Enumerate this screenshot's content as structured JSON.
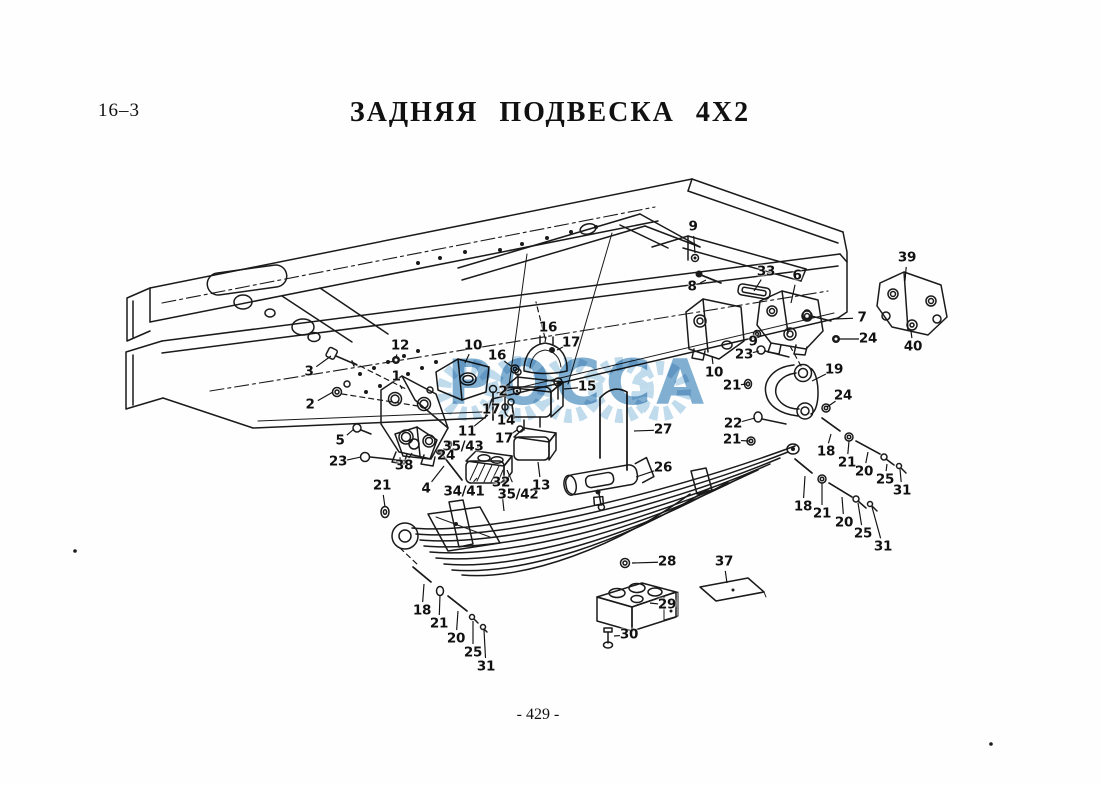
{
  "page": {
    "section_number": "16–3",
    "title": "ЗАДНЯЯ ПОДВЕСКА 4X2",
    "page_number": "- 429 -",
    "watermark_text": "РОССА",
    "watermark_color": "#5d9ac6",
    "ink_color": "#1a1a1a"
  },
  "diagram": {
    "description": "Exploded isometric parts view: truck ladder frame, spring brackets, shackle, multi-leaf spring, U-bolt, rubber buffers and fasteners",
    "callouts": [
      {
        "label": "9",
        "x": 693,
        "y": 227,
        "tx": 695,
        "ty": 253
      },
      {
        "label": "8",
        "x": 692,
        "y": 287,
        "tx": 706,
        "ty": 280
      },
      {
        "label": "33",
        "x": 766,
        "y": 272,
        "tx": 754,
        "ty": 291
      },
      {
        "label": "6",
        "x": 797,
        "y": 276,
        "tx": 791,
        "ty": 303
      },
      {
        "label": "7",
        "x": 862,
        "y": 318,
        "tx": 833,
        "ty": 319
      },
      {
        "label": "24",
        "x": 868,
        "y": 339,
        "tx": 838,
        "ty": 339
      },
      {
        "label": "39",
        "x": 907,
        "y": 258,
        "tx": 905,
        "ty": 281
      },
      {
        "label": "40",
        "x": 913,
        "y": 347,
        "tx": 911,
        "ty": 331
      },
      {
        "label": "9",
        "x": 753,
        "y": 342,
        "tx": 758,
        "ty": 337
      },
      {
        "label": "23",
        "x": 744,
        "y": 355,
        "tx": 759,
        "ty": 351
      },
      {
        "label": "10",
        "x": 714,
        "y": 373,
        "tx": 712,
        "ty": 356
      },
      {
        "label": "21",
        "x": 732,
        "y": 386,
        "tx": 746,
        "ty": 384
      },
      {
        "label": "19",
        "x": 834,
        "y": 370,
        "tx": 812,
        "ty": 381
      },
      {
        "label": "24",
        "x": 843,
        "y": 396,
        "tx": 827,
        "ty": 407
      },
      {
        "label": "22",
        "x": 733,
        "y": 424,
        "tx": 755,
        "ty": 418
      },
      {
        "label": "21",
        "x": 732,
        "y": 440,
        "tx": 749,
        "ty": 441
      },
      {
        "label": "18",
        "x": 826,
        "y": 452,
        "tx": 831,
        "ty": 434
      },
      {
        "label": "21",
        "x": 847,
        "y": 463,
        "tx": 849,
        "ty": 441
      },
      {
        "label": "20",
        "x": 864,
        "y": 472,
        "tx": 868,
        "ty": 452
      },
      {
        "label": "25",
        "x": 885,
        "y": 480,
        "tx": 887,
        "ty": 464
      },
      {
        "label": "31",
        "x": 902,
        "y": 491,
        "tx": 900,
        "ty": 469
      },
      {
        "label": "18",
        "x": 803,
        "y": 507,
        "tx": 805,
        "ty": 476
      },
      {
        "label": "21",
        "x": 822,
        "y": 514,
        "tx": 822,
        "ty": 483
      },
      {
        "label": "20",
        "x": 844,
        "y": 523,
        "tx": 842,
        "ty": 497
      },
      {
        "label": "25",
        "x": 863,
        "y": 534,
        "tx": 858,
        "ty": 503
      },
      {
        "label": "31",
        "x": 883,
        "y": 547,
        "tx": 872,
        "ty": 507
      },
      {
        "label": "3",
        "x": 309,
        "y": 372,
        "tx": 331,
        "ty": 356
      },
      {
        "label": "12",
        "x": 400,
        "y": 346,
        "tx": 396,
        "ty": 357
      },
      {
        "label": "10",
        "x": 473,
        "y": 346,
        "tx": 465,
        "ty": 363
      },
      {
        "label": "1",
        "x": 396,
        "y": 377,
        "tx": 402,
        "ty": 389
      },
      {
        "label": "2",
        "x": 310,
        "y": 405,
        "tx": 333,
        "ty": 392
      },
      {
        "label": "5",
        "x": 340,
        "y": 441,
        "tx": 354,
        "ty": 429
      },
      {
        "label": "23",
        "x": 338,
        "y": 462,
        "tx": 361,
        "ty": 457
      },
      {
        "label": "38",
        "x": 404,
        "y": 466,
        "tx": 412,
        "ty": 453
      },
      {
        "label": "21",
        "x": 382,
        "y": 486,
        "tx": 385,
        "ty": 507
      },
      {
        "label": "4",
        "x": 426,
        "y": 489,
        "tx": 444,
        "ty": 466
      },
      {
        "label": "16",
        "x": 548,
        "y": 328,
        "tx": 545,
        "ty": 342
      },
      {
        "label": "17",
        "x": 571,
        "y": 343,
        "tx": 557,
        "ty": 350
      },
      {
        "label": "16",
        "x": 497,
        "y": 356,
        "tx": 511,
        "ty": 366
      },
      {
        "label": "2",
        "x": 503,
        "y": 392,
        "tx": 513,
        "ty": 391
      },
      {
        "label": "15",
        "x": 587,
        "y": 387,
        "tx": 564,
        "ty": 389
      },
      {
        "label": "17",
        "x": 491,
        "y": 410,
        "tx": 501,
        "ty": 407
      },
      {
        "label": "14",
        "x": 506,
        "y": 421,
        "tx": 511,
        "ty": 413
      },
      {
        "label": "11",
        "x": 467,
        "y": 432,
        "tx": 488,
        "ty": 415
      },
      {
        "label": "17",
        "x": 504,
        "y": 439,
        "tx": 517,
        "ty": 430
      },
      {
        "label": "35/43",
        "x": 463,
        "y": 447,
        "tx": 479,
        "ty": 447
      },
      {
        "label": "24",
        "x": 446,
        "y": 456,
        "tx": 449,
        "ty": 448
      },
      {
        "label": "34/41",
        "x": 464,
        "y": 492,
        "tx": 477,
        "ty": 478
      },
      {
        "label": "32",
        "x": 501,
        "y": 483,
        "tx": 504,
        "ty": 511
      },
      {
        "label": "35/42",
        "x": 518,
        "y": 495,
        "tx": 507,
        "ty": 470
      },
      {
        "label": "13",
        "x": 541,
        "y": 486,
        "tx": 538,
        "ty": 462
      },
      {
        "label": "27",
        "x": 663,
        "y": 430,
        "tx": 634,
        "ty": 431
      },
      {
        "label": "26",
        "x": 663,
        "y": 468,
        "tx": 636,
        "ty": 477
      },
      {
        "label": "28",
        "x": 667,
        "y": 562,
        "tx": 632,
        "ty": 563
      },
      {
        "label": "29",
        "x": 667,
        "y": 605,
        "tx": 650,
        "ty": 603
      },
      {
        "label": "30",
        "x": 629,
        "y": 635,
        "tx": 614,
        "ty": 636
      },
      {
        "label": "37",
        "x": 724,
        "y": 562,
        "tx": 727,
        "ty": 583
      },
      {
        "label": "18",
        "x": 422,
        "y": 611,
        "tx": 424,
        "ty": 584
      },
      {
        "label": "21",
        "x": 439,
        "y": 624,
        "tx": 440,
        "ty": 595
      },
      {
        "label": "20",
        "x": 456,
        "y": 639,
        "tx": 458,
        "ty": 611
      },
      {
        "label": "25",
        "x": 473,
        "y": 653,
        "tx": 473,
        "ty": 621
      },
      {
        "label": "31",
        "x": 486,
        "y": 667,
        "tx": 484,
        "ty": 630
      }
    ]
  }
}
